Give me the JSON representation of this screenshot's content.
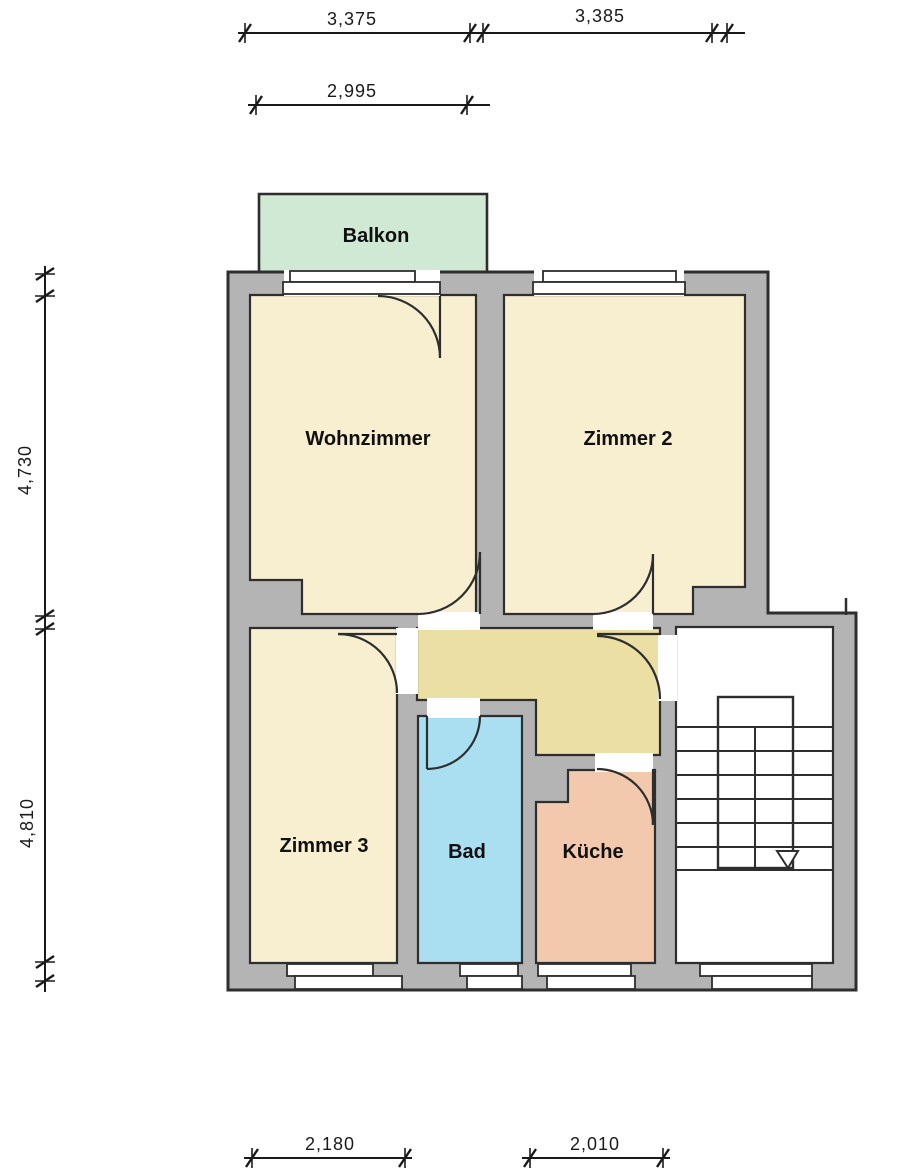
{
  "plan": {
    "room_labels": {
      "balkon": "Balkon",
      "wohnzimmer": "Wohnzimmer",
      "zimmer2": "Zimmer 2",
      "zimmer3": "Zimmer 3",
      "bad": "Bad",
      "kueche": "Küche"
    },
    "dimensions": {
      "top_left": "3,375",
      "top_right": "3,385",
      "top_inner": "2,995",
      "left_upper": "4,730",
      "left_lower": "4,810",
      "bottom_left": "2,180",
      "bottom_right": "2,010"
    },
    "colors": {
      "wall": "#b4b4b4",
      "outline": "#2e2e2e",
      "room_cream": "#f8efd1",
      "hallway_tan": "#ecdfa4",
      "balcony_green": "#cfe9d4",
      "bath_blue": "#a9dff0",
      "kitchen_salmon": "#f3c9ae",
      "stairwell_white": "#ffffff"
    }
  }
}
